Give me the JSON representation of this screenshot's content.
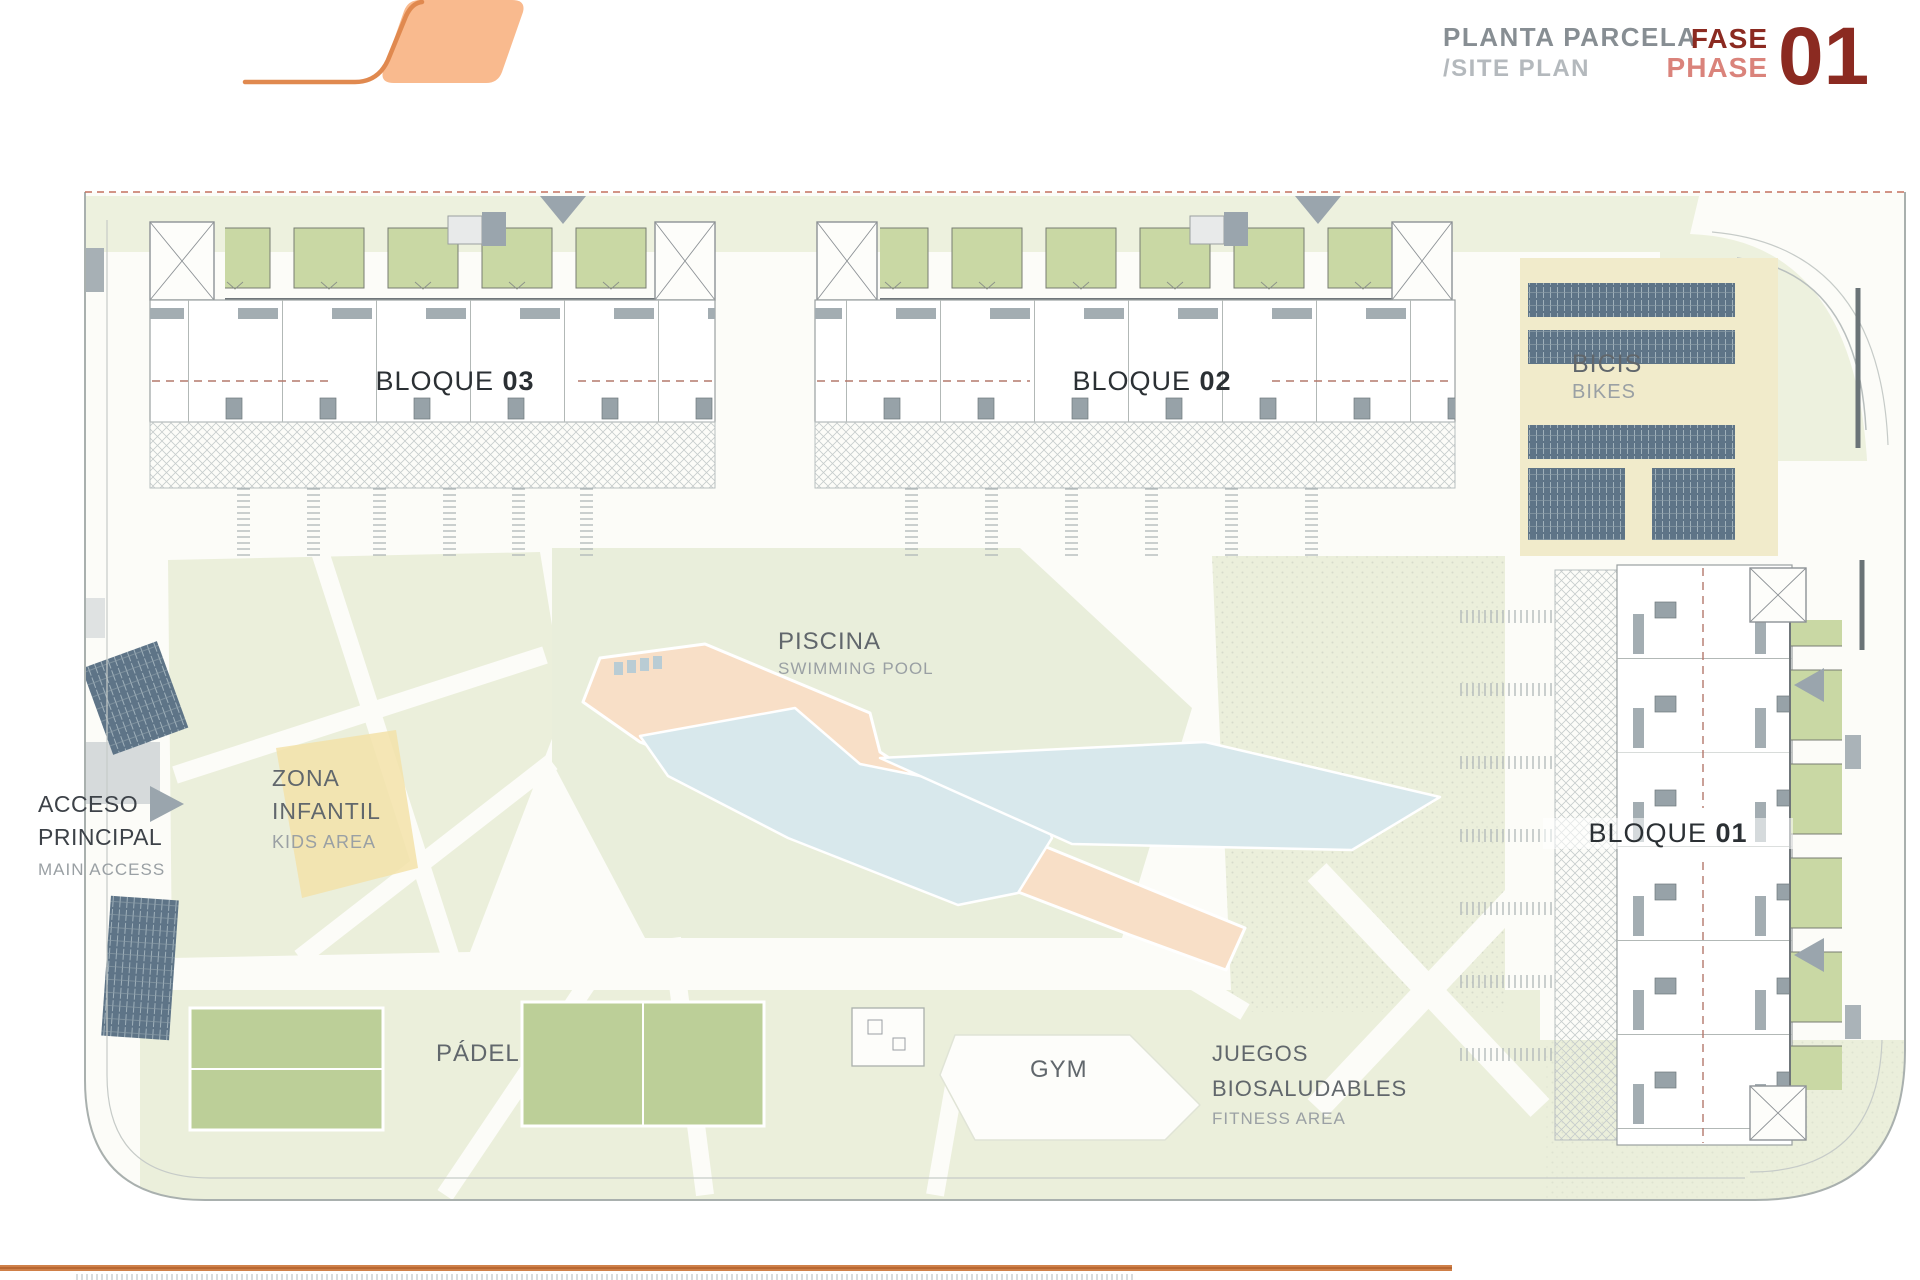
{
  "header": {
    "title_primary": "PLANTA PARCELA",
    "title_secondary": "/SITE PLAN",
    "phase_label_es": "FASE",
    "phase_label_en": "PHASE",
    "phase_number": "01"
  },
  "plan": {
    "blocks": {
      "b03_name": "BLOQUE",
      "b03_num": "03",
      "b02_name": "BLOQUE",
      "b02_num": "02",
      "b01_name": "BLOQUE",
      "b01_num": "01"
    },
    "areas": {
      "bikes_es": "BICIS",
      "bikes_en": "BIKES",
      "pool_es": "PISCINA",
      "pool_en": "SWIMMING POOL",
      "kids_es1": "ZONA",
      "kids_es2": "INFANTIL",
      "kids_en": "KIDS AREA",
      "access_es1": "ACCESO",
      "access_es2": "PRINCIPAL",
      "access_en": "MAIN ACCESS",
      "padel": "PÁDEL",
      "gym": "GYM",
      "fitness_es1": "JUEGOS",
      "fitness_es2": "BIOSALUDABLES",
      "fitness_en": "FITNESS AREA"
    }
  },
  "colors": {
    "accent_orange": "#e0894f",
    "logo_fill": "#f9ba8e",
    "phase_dark": "#8b2a21",
    "phase_light": "#da837b",
    "title_gray": "#878e93",
    "lawn_green": "#ebefdb",
    "garden_green": "#c9d8a4",
    "pool_water": "#d8e8ec",
    "pool_deck": "#f8dfc7",
    "bike_rack": "#5e7487",
    "dashed_line": "#c4705f"
  }
}
